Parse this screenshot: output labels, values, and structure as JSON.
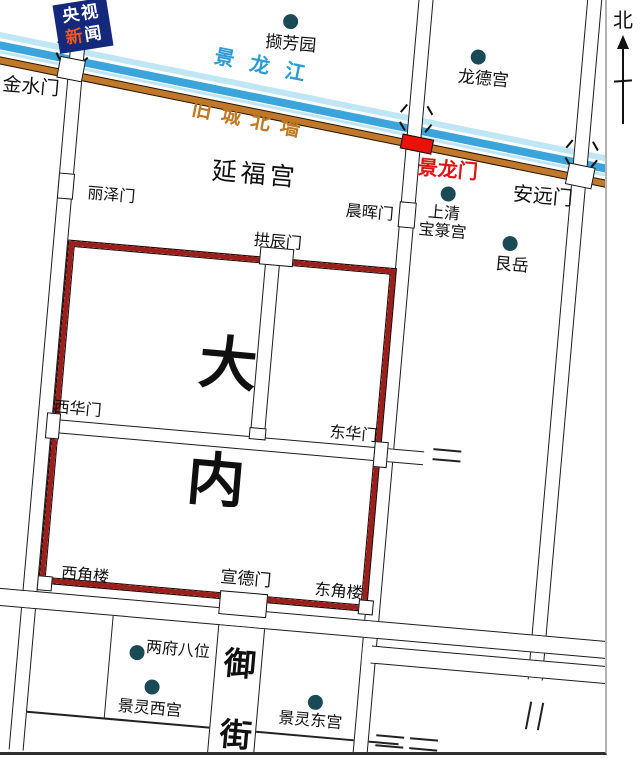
{
  "logo": {
    "line1": "央视",
    "line2_char1": "新",
    "line2_char2": "闻"
  },
  "north_label": "北",
  "colors": {
    "river_pale": "#bfe6f5",
    "river_blue": "#3ba4da",
    "old_wall_orange": "#c0792b",
    "palace_wall_red": "#9b1f1a",
    "gate_red": "#ea1108",
    "red_label": "#df1414",
    "river_label_blue": "#2b9cd8",
    "wall_label_orange": "#bf7722",
    "poi_dot": "#1a4a55",
    "logo_bg": "#14297c",
    "logo_orange": "#f4581c"
  },
  "labels": [
    {
      "id": "jinglongjiang",
      "text": "景龙江",
      "x": 188,
      "y": 56,
      "size": 20,
      "color": "#2b9cd8",
      "spacing": 16,
      "rotate": 6.5,
      "bold": true
    },
    {
      "id": "jiucheng-beiqiang",
      "text": "旧城北墙",
      "x": 170,
      "y": 110,
      "size": 20,
      "color": "#bf7722",
      "spacing": 10,
      "rotate": 6.5,
      "bold": true
    },
    {
      "id": "jinshuimen",
      "text": "金水门",
      "x": -22,
      "y": 104,
      "size": 19
    },
    {
      "id": "lizemen",
      "text": "丽泽门",
      "x": 72,
      "y": 206,
      "size": 16
    },
    {
      "id": "yanfugong",
      "text": "延福宫",
      "x": 194,
      "y": 168,
      "size": 25,
      "spacing": 4
    },
    {
      "id": "gongchenmen",
      "text": "拱辰门",
      "x": 242,
      "y": 238,
      "size": 16
    },
    {
      "id": "chenhuimen",
      "text": "晨晖门",
      "x": 331,
      "y": 201,
      "size": 16
    },
    {
      "id": "jinglongmen",
      "text": "景龙门",
      "x": 399,
      "y": 149,
      "size": 20,
      "color": "#df1414",
      "bold": true
    },
    {
      "id": "anyuanmen",
      "text": "安远门",
      "x": 496,
      "y": 167,
      "size": 20
    },
    {
      "id": "shangqing-1",
      "text": "上清",
      "x": 413,
      "y": 195,
      "size": 16
    },
    {
      "id": "shangqing-2",
      "text": "宝箓宫",
      "x": 405,
      "y": 213,
      "size": 16
    },
    {
      "id": "genyue",
      "text": "艮岳",
      "x": 484,
      "y": 241,
      "size": 17
    },
    {
      "id": "longdegong",
      "text": "龙德宫",
      "x": 431,
      "y": 58,
      "size": 17
    },
    {
      "id": "xiefangyuan",
      "text": "撷芳园",
      "x": 236,
      "y": 40,
      "size": 17
    },
    {
      "id": "xihuamen",
      "text": "西华门",
      "x": 57,
      "y": 422,
      "size": 16
    },
    {
      "id": "donghuamen",
      "text": "东华门",
      "x": 334,
      "y": 423,
      "size": 16
    },
    {
      "id": "danei-da",
      "text": "大",
      "x": 198,
      "y": 342,
      "size": 58,
      "bold": true
    },
    {
      "id": "danei-nei",
      "text": "内",
      "x": 196,
      "y": 459,
      "size": 58,
      "bold": true
    },
    {
      "id": "xijiaolou",
      "text": "西角楼",
      "x": 79,
      "y": 587,
      "size": 16
    },
    {
      "id": "xuandemen",
      "text": "宣德门",
      "x": 238,
      "y": 577,
      "size": 17
    },
    {
      "id": "dongjiaolou",
      "text": "东角楼",
      "x": 333,
      "y": 581,
      "size": 16
    },
    {
      "id": "yujie-yu",
      "text": "御",
      "x": 249,
      "y": 654,
      "size": 32,
      "bold": true
    },
    {
      "id": "yujie-jie",
      "text": "街",
      "x": 251,
      "y": 725,
      "size": 32,
      "bold": true
    },
    {
      "id": "liangfubawei",
      "text": "两府八位",
      "x": 170,
      "y": 653,
      "size": 16
    },
    {
      "id": "jingling-xigong",
      "text": "景灵西宫",
      "x": 147,
      "y": 714,
      "size": 16
    },
    {
      "id": "jingling-donggong",
      "text": "景灵东宫",
      "x": 308,
      "y": 712,
      "size": 16
    }
  ],
  "dots": [
    {
      "id": "xiefangyuan",
      "x": 259,
      "y": 25
    },
    {
      "id": "longdegong",
      "x": 449,
      "y": 44
    },
    {
      "id": "shangqing-baolugong",
      "x": 431,
      "y": 183
    },
    {
      "id": "genyue",
      "x": 497,
      "y": 227
    },
    {
      "id": "liangfubawei",
      "x": 161,
      "y": 667
    },
    {
      "id": "jingling-xigong",
      "x": 179,
      "y": 700
    },
    {
      "id": "jingling-donggong",
      "x": 343,
      "y": 701
    }
  ],
  "gates": [
    {
      "id": "jinshuimen",
      "x": 32,
      "y": 81,
      "w": 26,
      "h": 22,
      "fill": "white",
      "rotate": 6
    },
    {
      "id": "lizemen",
      "x": 42,
      "y": 196,
      "w": 16,
      "h": 26,
      "fill": "white",
      "rotate": 0
    },
    {
      "id": "gongchenmen",
      "x": 249,
      "y": 252,
      "w": 34,
      "h": 18,
      "fill": "white",
      "rotate": 0
    },
    {
      "id": "chenhuimen",
      "x": 384,
      "y": 195,
      "w": 17,
      "h": 26,
      "fill": "white",
      "rotate": 0
    },
    {
      "id": "jinglongmen",
      "x": 380,
      "y": 129,
      "w": 32,
      "h": 15,
      "fill": "red",
      "rotate": 6.5
    },
    {
      "id": "anyuanmen",
      "x": 548,
      "y": 143,
      "w": 27,
      "h": 22,
      "fill": "white",
      "rotate": 6.5
    },
    {
      "id": "xihuamen",
      "x": 51,
      "y": 436,
      "w": 14,
      "h": 26,
      "fill": "white",
      "rotate": 0
    },
    {
      "id": "donghuamen",
      "x": 380,
      "y": 436,
      "w": 14,
      "h": 26,
      "fill": "white",
      "rotate": 0
    },
    {
      "id": "xuandemen",
      "x": 239,
      "y": 598,
      "w": 48,
      "h": 24,
      "fill": "white",
      "rotate": 0
    },
    {
      "id": "corridor-junction",
      "x": 254,
      "y": 433,
      "w": 17,
      "h": 12,
      "fill": "white",
      "rotate": 0
    },
    {
      "id": "xijiaolou",
      "x": 56,
      "y": 599,
      "w": 15,
      "h": 15,
      "fill": "white",
      "rotate": 0
    },
    {
      "id": "dongjiaolou",
      "x": 378,
      "y": 595,
      "w": 15,
      "h": 15,
      "fill": "white",
      "rotate": 0
    }
  ]
}
